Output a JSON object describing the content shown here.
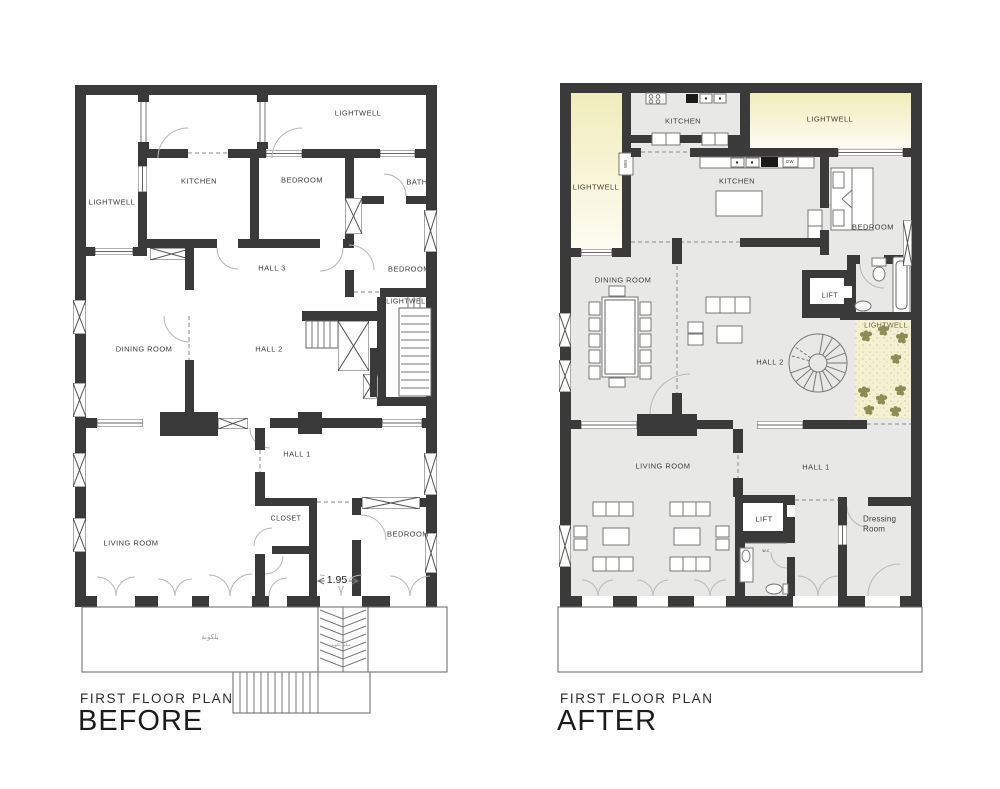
{
  "before": {
    "subtitle": "FIRST FLOOR PLAN",
    "title": "BEFORE",
    "rooms": {
      "lightwell_top": "LIGHTWELL",
      "kitchen": "KITCHEN",
      "bedroom_top": "BEDROOM",
      "bath": "BATH",
      "lightwell_left": "LIGHTWELL",
      "hall_3": "HALL 3",
      "bedroom_right": "BEDROOM",
      "lightwell_right": "LIGHTWELL",
      "dining_room": "DINING ROOM",
      "hall_2": "HALL 2",
      "hall_1": "HALL 1",
      "closet": "CLOSET",
      "living_room": "LIVING ROOM",
      "bedroom_bottom": "BEDROOM"
    },
    "dimension_label": "1.95",
    "balcony_label": "بلكونة",
    "balcony_stairs_label": "سلم بلكونة"
  },
  "after": {
    "subtitle": "FIRST FLOOR PLAN",
    "title": "AFTER",
    "rooms": {
      "kitchen_top": "KITCHEN",
      "lightwell_top": "LIGHTWELL",
      "lightwell_left": "LIGHTWELL",
      "kitchen_main": "KITCHEN",
      "bedroom": "BEDROOM",
      "dining_room": "DINING ROOM",
      "lift_upper": "LIFT",
      "hall_2": "HALL 2",
      "lightwell_garden": "LIGHTWELL",
      "living_room": "LIVING ROOM",
      "hall_1": "HALL 1",
      "lift_lower": "LIFT",
      "wc": "w.c",
      "dressing_room": "Dressing Room",
      "washing_machine": "WM",
      "dishwasher": "DW"
    }
  },
  "colors": {
    "wall": "#3a3a3a",
    "floor": "#e8e8e7",
    "lightwell": "#f1ecba",
    "garden": "#f5f0cf",
    "plant": "#8c8c55"
  }
}
